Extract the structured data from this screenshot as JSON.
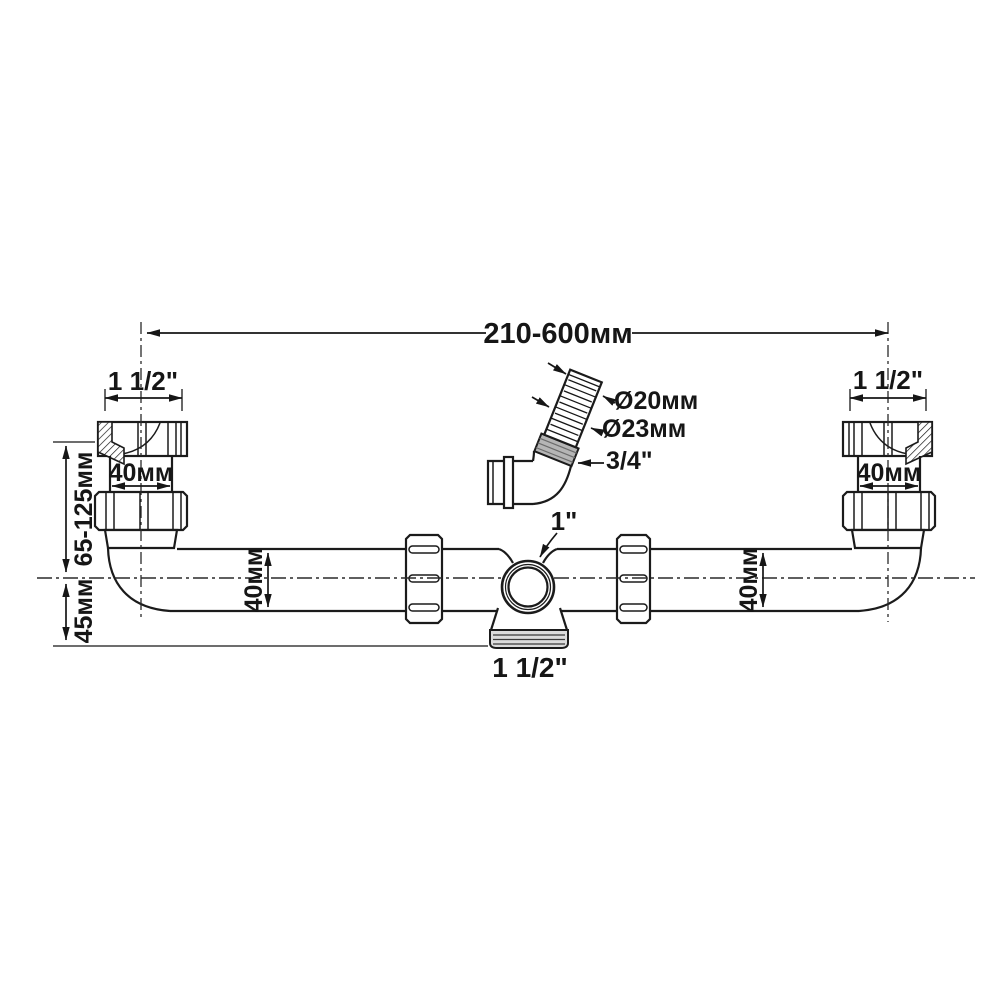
{
  "diagram": {
    "type": "technical-dimension-drawing",
    "subject": "double-bowl sink waste pipe / trap assembly",
    "labels": {
      "top_span": "210-600мм",
      "left_inlet_size": "1 1/2\"",
      "right_inlet_size": "1 1/2\"",
      "left_inlet_width": "40мм",
      "right_inlet_width": "40мм",
      "height_range": "65-125мм",
      "center_drop": "45мм",
      "left_pipe_diameter": "40мм",
      "right_pipe_diameter": "40мм",
      "hose_inner_diameter": "Ø20мм",
      "hose_outer_diameter": "Ø23мм",
      "hose_nut_size": "3/4\"",
      "tee_inlet_size": "1\"",
      "tee_outlet_size": "1 1/2\""
    },
    "colors": {
      "line": "#1b1b1b",
      "background": "#ffffff",
      "hose_collar_fill": "#b5b5b5",
      "thread_fill": "#dcdcdc"
    }
  }
}
